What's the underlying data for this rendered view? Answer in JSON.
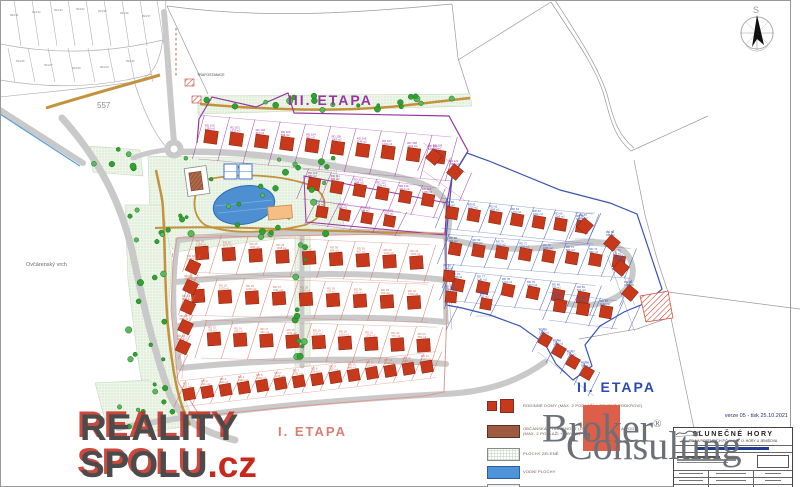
{
  "map": {
    "labels": {
      "etapa3": "III.  ETAPA",
      "etapa2": "II.  ETAPA",
      "etapa1": "I.  ETAPA",
      "parcel_557": "557",
      "hill": "Ovčárenský vrch",
      "trafo": "TRAFOSTANICE",
      "compass_north": "S"
    },
    "colors": {
      "etapa1_outline": "#d4705f",
      "etapa2_outline": "#3a55b4",
      "etapa3_outline": "#9a35a0",
      "house": "#c8391b",
      "house_edge": "#7e2410",
      "water": "#4d8fd1",
      "road": "#c9c9c9",
      "path_gold": "#c3923c",
      "tree": "#33a033",
      "hatch_red": "#cc4433",
      "brown": "#9e5a40"
    },
    "plot_label_format": {
      "name": "RD {n}",
      "area": "{a} m2"
    },
    "plots": {
      "rows": [
        {
          "etapa": 3,
          "n": 10,
          "x": 211,
          "y": 137,
          "dx": 25.3,
          "dy": 2.2,
          "sq": 13,
          "rot": 8,
          "depth": 22,
          "start": 100
        },
        {
          "etapa": 3,
          "n": 6,
          "x": 314,
          "y": 184,
          "dx": 22.8,
          "dy": 3.2,
          "sq": 12,
          "rot": 10,
          "depth": 15,
          "start": 110
        },
        {
          "etapa": 3,
          "n": 4,
          "x": 322,
          "y": 212,
          "dx": 22.5,
          "dy": 3,
          "sq": 11,
          "rot": 10,
          "depth": 12,
          "start": 116
        },
        {
          "etapa": 3,
          "n": 2,
          "x": 434,
          "y": 157,
          "dx": 21,
          "dy": 15,
          "sq": 12,
          "rot": 40,
          "depth": 14,
          "start": 120
        },
        {
          "etapa": 2,
          "n": 7,
          "x": 452,
          "y": 213,
          "dx": 21.7,
          "dy": 2.3,
          "sq": 12,
          "rot": 10,
          "depth": 15,
          "start": 60
        },
        {
          "etapa": 2,
          "n": 1,
          "x": 585,
          "y": 226,
          "dx": 20,
          "dy": 0,
          "sq": 12,
          "rot": 40,
          "depth": 13,
          "start": 67
        },
        {
          "etapa": 2,
          "n": 8,
          "x": 455,
          "y": 249,
          "dx": 23.4,
          "dy": 1.8,
          "sq": 12,
          "rot": 10,
          "depth": 15,
          "start": 68
        },
        {
          "etapa": 2,
          "n": 6,
          "x": 458,
          "y": 285,
          "dx": 25,
          "dy": 2.6,
          "sq": 12,
          "rot": 12,
          "depth": 15,
          "start": 76
        },
        {
          "etapa": 2,
          "n": 3,
          "x": 612,
          "y": 243,
          "dx": 9,
          "dy": 25,
          "sq": 12,
          "rot": 40,
          "depth": 13,
          "start": 89
        },
        {
          "etapa": 2,
          "n": 3,
          "x": 560,
          "y": 306,
          "dx": 23,
          "dy": 3,
          "sq": 12,
          "rot": 10,
          "depth": 14,
          "start": 82
        },
        {
          "etapa": 2,
          "n": 4,
          "x": 545,
          "y": 340,
          "dx": 14,
          "dy": 11,
          "sq": 11,
          "rot": 30,
          "depth": 12,
          "start": 85
        },
        {
          "etapa": 2,
          "n": 2,
          "x": 449,
          "y": 276,
          "dx": 2,
          "dy": 21,
          "sq": 11,
          "rot": 5,
          "depth": 12,
          "start": 92
        },
        {
          "etapa": 2,
          "n": 1,
          "x": 486,
          "y": 304,
          "dx": 20,
          "dy": 0,
          "sq": 11,
          "rot": 10,
          "depth": 12,
          "start": 94
        },
        {
          "etapa": 1,
          "n": 9,
          "x": 202,
          "y": 253,
          "dx": 26.8,
          "dy": 1.2,
          "sq": 13,
          "rot": -4,
          "depth": 19,
          "start": 33
        },
        {
          "etapa": 1,
          "n": 9,
          "x": 198,
          "y": 296,
          "dx": 27,
          "dy": 0.8,
          "sq": 13,
          "rot": -4,
          "depth": 19,
          "start": 24
        },
        {
          "etapa": 1,
          "n": 9,
          "x": 214,
          "y": 339,
          "dx": 26.2,
          "dy": 0.8,
          "sq": 13,
          "rot": -4,
          "depth": 19,
          "start": 15
        },
        {
          "etapa": 1,
          "n": 14,
          "x": 189,
          "y": 394,
          "dx": 18.3,
          "dy": -2.1,
          "sq": 11.5,
          "rot": -10,
          "depth": 13,
          "start": 1
        },
        {
          "etapa": 1,
          "n": 5,
          "x": 193,
          "y": 267,
          "dx": -2.5,
          "dy": 20,
          "sq": 12,
          "rot": 25,
          "depth": 12,
          "start": 42
        }
      ]
    },
    "greens": {
      "polys": [
        "148,156 335,160 345,232 250,242 175,252 150,215",
        "125,205 162,205 172,260 168,320 178,380 195,425 150,430 138,360 128,280",
        "198,96 470,94 472,106 198,114",
        "295,228 310,228 310,366 295,366",
        "90,146 140,150 143,176 93,172",
        "95,383 148,380 175,395 195,425 150,432 105,420"
      ],
      "tree_strips": [
        {
          "x": 150,
          "y": 158,
          "w": 185,
          "h": 80,
          "n": 26,
          "seed": 11
        },
        {
          "x": 128,
          "y": 208,
          "w": 42,
          "h": 205,
          "n": 18,
          "seed": 22
        },
        {
          "x": 200,
          "y": 95,
          "w": 268,
          "h": 15,
          "n": 20,
          "seed": 33
        },
        {
          "x": 295,
          "y": 232,
          "w": 13,
          "h": 130,
          "n": 12,
          "seed": 44
        },
        {
          "x": 92,
          "y": 147,
          "w": 46,
          "h": 26,
          "n": 6,
          "seed": 55
        },
        {
          "x": 100,
          "y": 383,
          "w": 85,
          "h": 45,
          "n": 8,
          "seed": 66
        },
        {
          "x": 255,
          "y": 224,
          "w": 60,
          "h": 14,
          "n": 5,
          "seed": 77
        }
      ]
    },
    "cadastre": {
      "labels": [
        {
          "t": "994/31",
          "x": 10,
          "y": 16
        },
        {
          "t": "994/32",
          "x": 32,
          "y": 13
        },
        {
          "t": "994/33",
          "x": 54,
          "y": 11
        },
        {
          "t": "994/34",
          "x": 76,
          "y": 10
        },
        {
          "t": "994/35",
          "x": 98,
          "y": 12
        },
        {
          "t": "994/36",
          "x": 120,
          "y": 14
        },
        {
          "t": "994/37",
          "x": 142,
          "y": 17
        },
        {
          "t": "994/26",
          "x": 16,
          "y": 62
        },
        {
          "t": "994/27",
          "x": 44,
          "y": 66
        },
        {
          "t": "994/28",
          "x": 72,
          "y": 69
        },
        {
          "t": "994/29",
          "x": 100,
          "y": 68
        },
        {
          "t": "994/30",
          "x": 126,
          "y": 62
        }
      ]
    }
  },
  "legend": {
    "items": [
      {
        "label": "RODINNÉ DOMY (MAX. 2 PODLAŽÍ + OBYTNÉ PODKROVÍ)"
      },
      {
        "label": "OBČANSKÁ VYBAVENOST (OBCHODY, SLUŽBY A POD.)",
        "label2": "(MAX. 2 PODLAŽÍ + OBYTNÉ PODKROVÍ)"
      },
      {
        "label": "PLOCHY ZELENĚ"
      },
      {
        "label": "VODNÍ PLOCHY"
      },
      {
        "label": ""
      }
    ]
  },
  "title_block": {
    "title": "SLUNEČNÉ HORY",
    "subtitle": "RD NA POZEMCÍCH P.Č. V KAT. Ú. HORY U JENIŠOVA",
    "version": "verze 05 - tisk 25.10.2021"
  },
  "watermarks": {
    "reality_line1": "REALITY",
    "reality_line2": "SPOLU",
    "reality_cz": ".cz",
    "broker_line1": "Broker",
    "broker_reg": "®",
    "broker_line2": "Consulting"
  }
}
